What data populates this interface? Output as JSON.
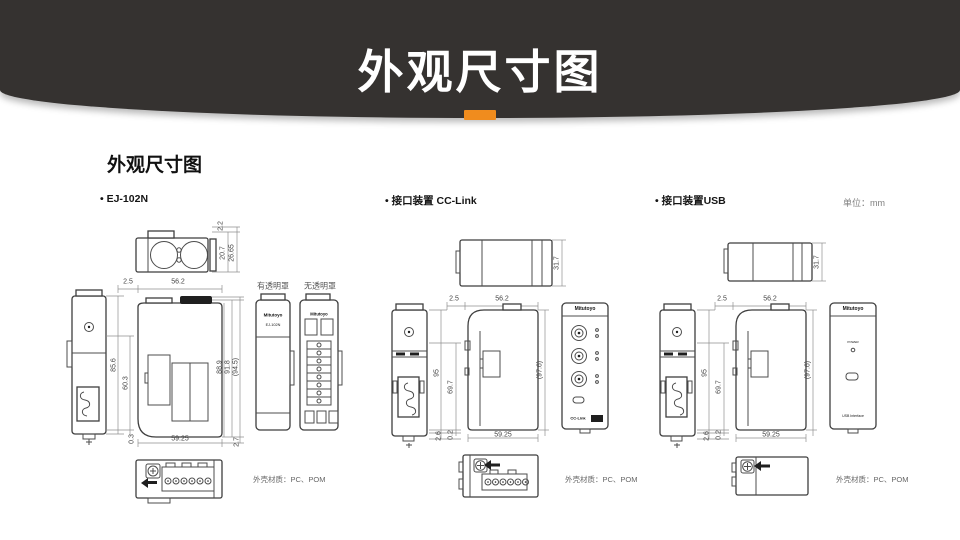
{
  "banner": {
    "title": "外观尺寸图",
    "accent_color": "#f08c1e",
    "bg_color": "#353230"
  },
  "content": {
    "section_title": "外观尺寸图",
    "unit": "单位：mm"
  },
  "ej": {
    "label": "• EJ-102N",
    "brand": "Mitutoyo",
    "model": "EJ-102N",
    "cover_with": "有透明罩",
    "cover_without": "无透明罩",
    "material": "外壳材质：PC、POM",
    "dims": {
      "top_offset": "2.2",
      "top_depth1": "20.7",
      "top_depth2": "26.65",
      "w_offset": "2.5",
      "w_top": "56.2",
      "h_body": "85.6",
      "h_inner": "60.3",
      "h_foot": "0.3",
      "w_bottom": "59.25",
      "w_right": "2.7",
      "h_r1": "88.9",
      "h_r2": "91.8",
      "h_r3": "(94.5)"
    }
  },
  "cc": {
    "label": "• 接口装置 CC-Link",
    "brand": "Mitutoyo",
    "logo": "CC-Link",
    "material": "外壳材质：PC、POM",
    "dims": {
      "t_height": "31.7",
      "w_offset": "2.5",
      "w_top": "56.2",
      "h_body": "95",
      "h_inner": "69.7",
      "h_total": "(97.6)",
      "h_foot1": "2.6",
      "h_foot2": "0.2",
      "w_bottom": "59.25"
    }
  },
  "usb": {
    "label": "• 接口装置USB",
    "brand": "Mitutoyo",
    "power": "POWER",
    "interface": "USB Interface",
    "material": "外壳材质：PC、POM",
    "dims": {
      "t_height": "31.7",
      "w_offset": "2.5",
      "w_top": "56.2",
      "h_body": "95",
      "h_inner": "69.7",
      "h_total": "(97.6)",
      "h_foot1": "2.6",
      "h_foot2": "0.2",
      "w_bottom": "59.25"
    }
  }
}
